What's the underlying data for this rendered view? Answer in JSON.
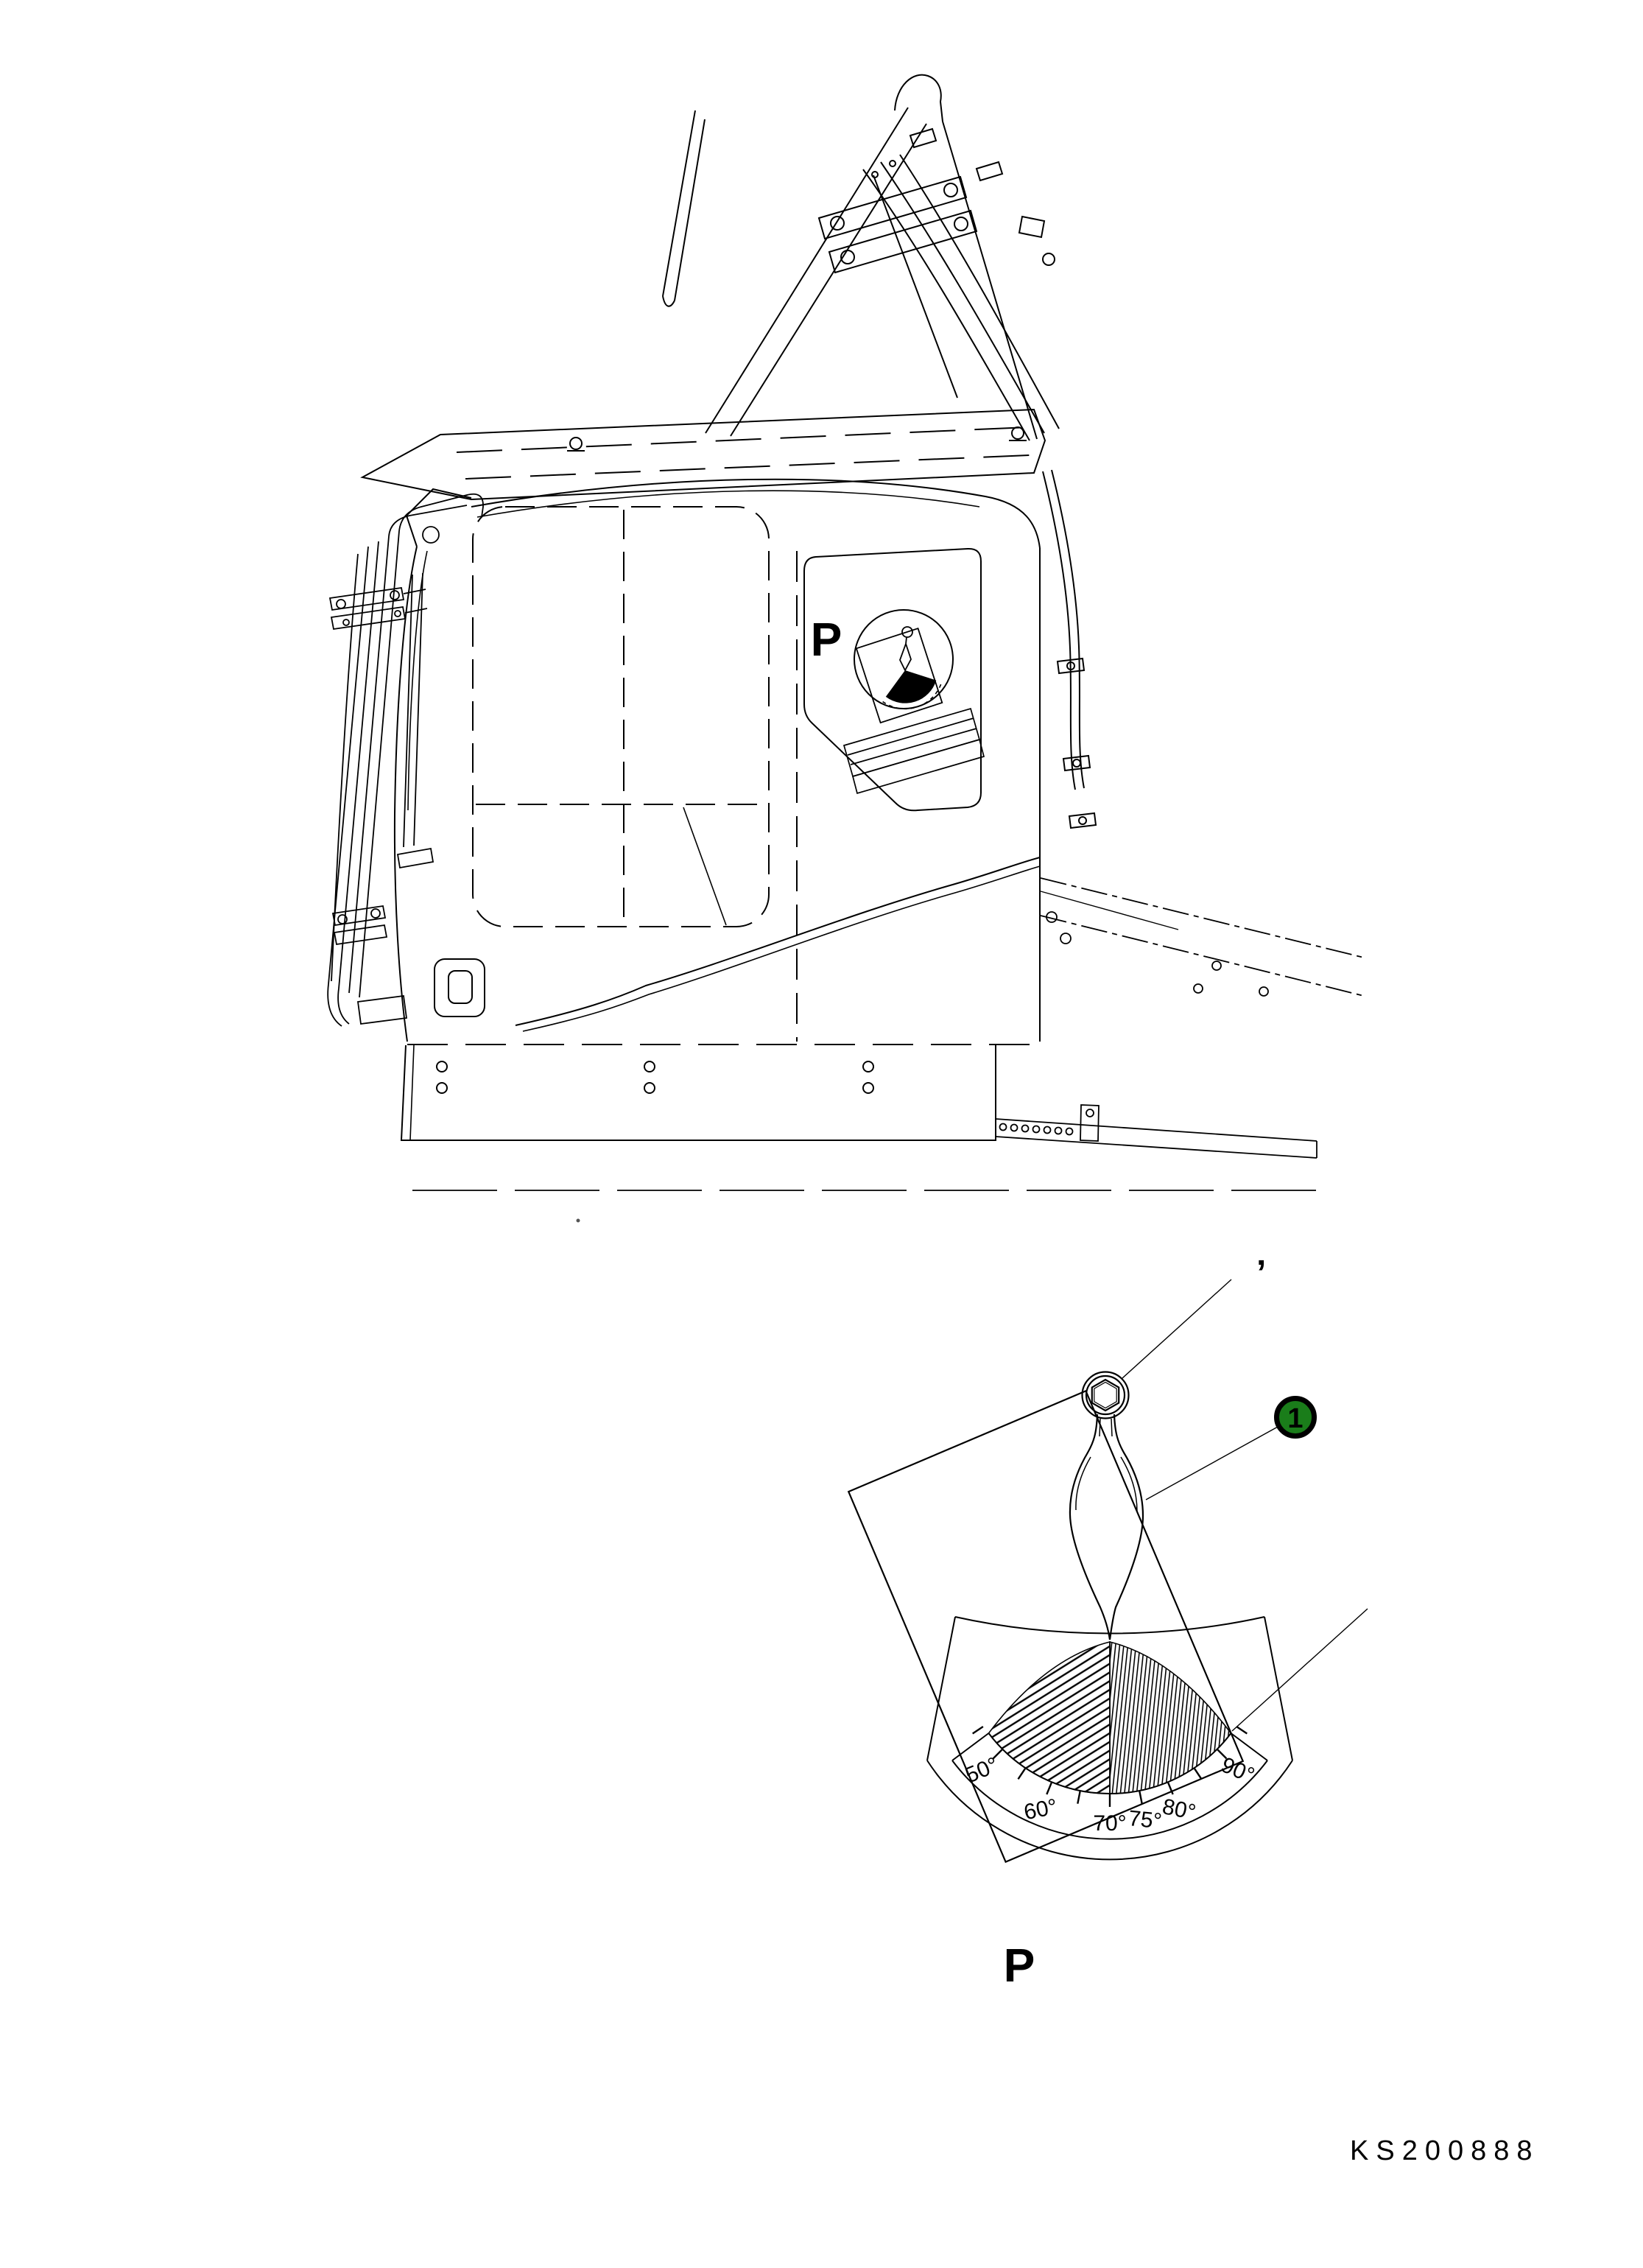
{
  "page": {
    "background": "#ffffff",
    "ink": "#000000"
  },
  "figure": {
    "machine_location_label": "P",
    "detail_view_label": "P",
    "drawing_code": "KS200888"
  },
  "callout": {
    "number": "1",
    "fill": "#1a7d1a",
    "ring": "#000000",
    "text_color": "#ffffff"
  },
  "decal": {
    "type": "angle-indicator-decal",
    "tick_labels": [
      "50°",
      "60°",
      "70°",
      "75°",
      "80°",
      "90°"
    ],
    "tick_marks_deg": [
      45,
      50,
      55,
      60,
      65,
      70,
      75,
      80,
      85,
      90,
      95
    ],
    "pointer": "plumb-bob-pendulum"
  },
  "marks": {
    "prime": "’"
  }
}
